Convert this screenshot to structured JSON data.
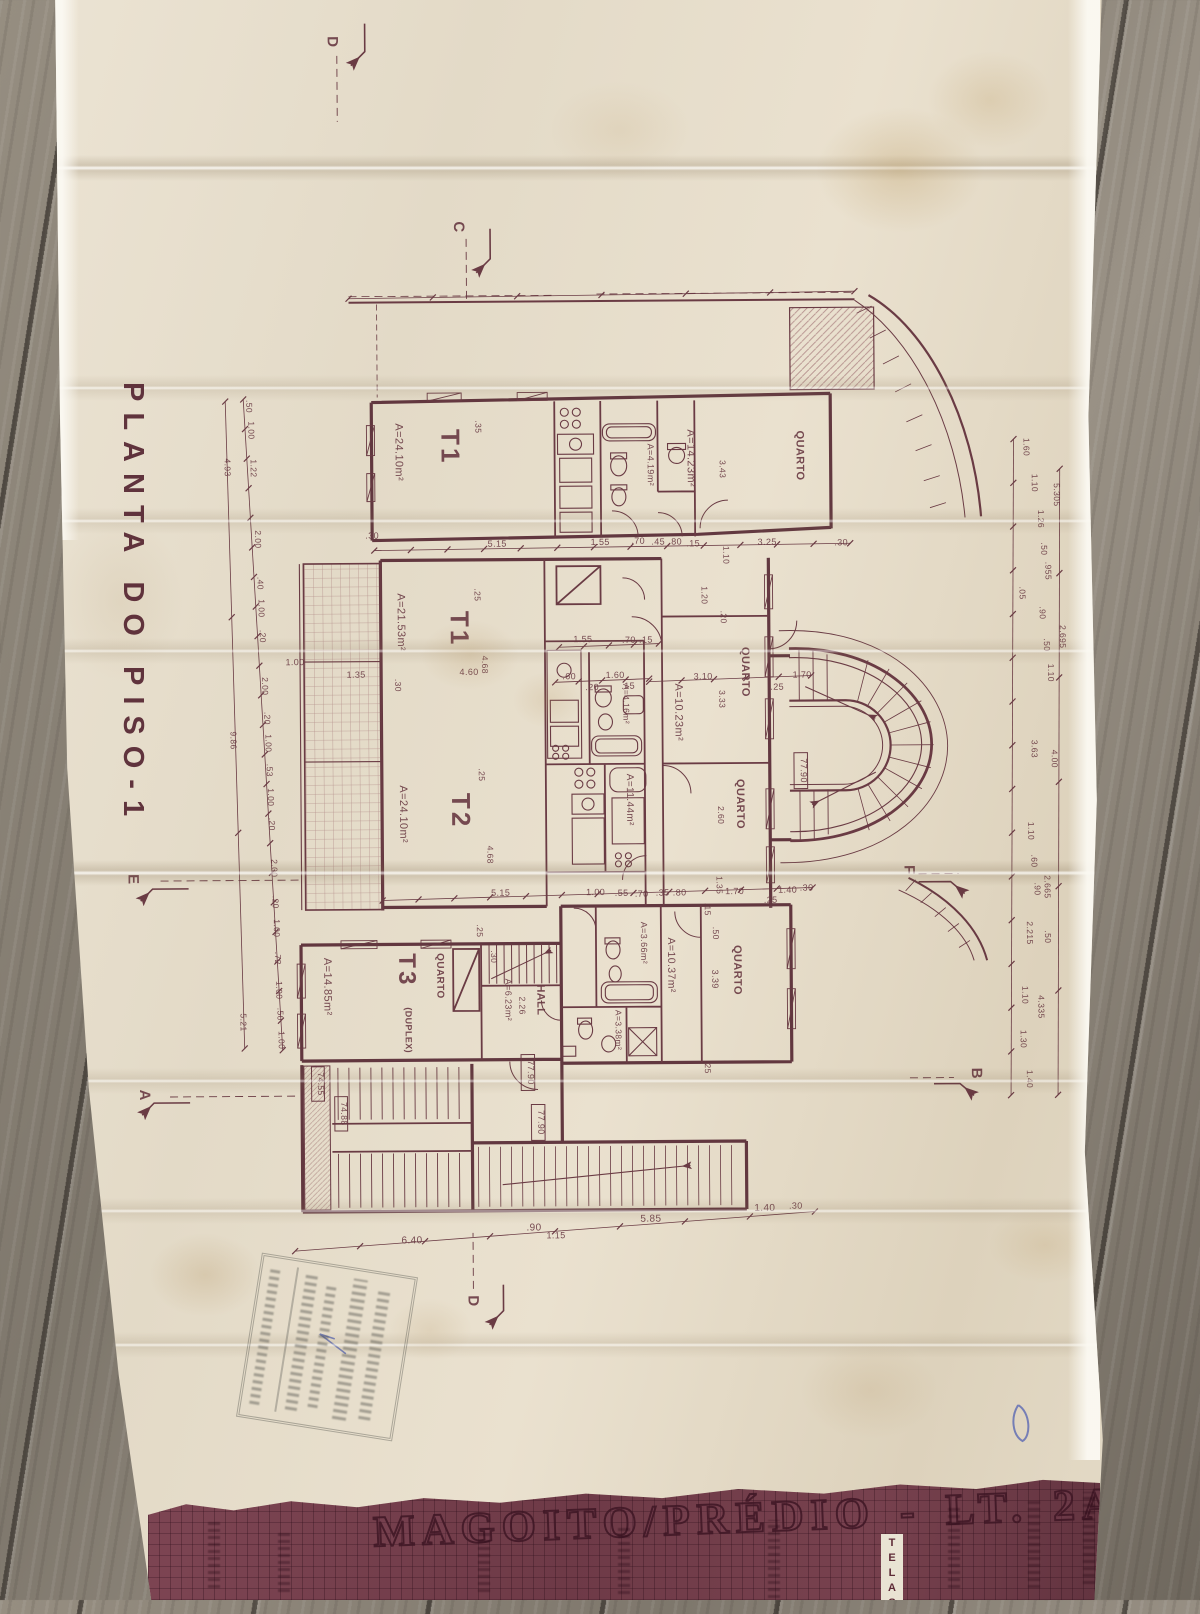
{
  "photo": {
    "plan_title": "PLANTA DO PISO-1",
    "cover_title": "MAGOITO/PRÉDIO - LT. 2A",
    "cover_tag": "TELAS"
  },
  "plan": {
    "labels": {
      "t1a": "T1",
      "t1a_area": "A=24.10m²",
      "q_top": "QUARTO",
      "q_top_area": "A=14.23m²",
      "bath_top_area": "A=4.19m²",
      "t1b": "T1",
      "t1b_area": "A=21.53m²",
      "bath_mid_area": "A=4.16m²",
      "q_m1": "QUARTO",
      "q_m1_area": "A=10.23m²",
      "q_m2": "QUARTO",
      "store_area": "A=11.44m²",
      "t2": "T2",
      "t2_area": "A=24.10m²",
      "t3": "T3",
      "t3_sub": "(DUPLEX)",
      "t3_area": "A=14.85m²",
      "q_t3": "QUARTO",
      "hall": "HALL",
      "hall_area": "A=6.23m²",
      "hall_dim": "2.26",
      "b1_area": "A=3.66m²",
      "b2_area": "A=3.38m²",
      "c_area": "A=10.37m²",
      "q_b": "QUARTO",
      "q_b_dim": "3.39",
      "el1": "77.90",
      "el2": "77.90",
      "el3": "77.90",
      "el4": "74.55",
      "el5": "74.88",
      "sD1": "D",
      "sC": "C",
      "sE": "E",
      "sF": "F",
      "sA": "A",
      "sB": "B",
      "sD2": "D",
      "h1": ".30",
      "h2": "5.15",
      "h3": "1.55",
      "h4": ".70",
      "h5": ".45",
      "h6": ".80",
      "h7": ".15",
      "h8": "3.25",
      "h9": ".30",
      "h10": "1.55",
      "h11": ".70",
      "h12": ".15",
      "h13": ".60",
      "h14": "1.60",
      "h15": ".20",
      "h16": ".15",
      "h17": "3.10",
      "h18": "1.70",
      "h19": ".25",
      "h20": "4.60",
      "h21": "1.35",
      "h22": "1.00",
      "h23": "5.15",
      "h24": "1.00",
      "h25": ".55",
      "h26": ".70",
      "h27": ".35",
      "h28": ".80",
      "h29": "1.70",
      "h30": "1.40",
      "h31": ".30",
      "h32": ".25",
      "h33": "6.40",
      "h34": ".90",
      "h35": "1.15",
      "h36": "5.85",
      "h37": "1.40",
      "h38": ".30",
      "v1": ".35",
      "v2": "3.43",
      "v3": "1.10",
      "v4": ".25",
      "v5": ".30",
      "v6": "4.68",
      "v7": "1.20",
      "v8": "3.33",
      "v9": ".20",
      "v10": "2.60",
      "v11": ".15",
      "v12": ".50",
      "v13": "1.35",
      "v14": ".25",
      "v15": ".30",
      "v16": ".25",
      "v17": "4.68",
      "v18": ".25",
      "L1": ".50",
      "L2": "1.00",
      "L3": "1.22",
      "L4": "2.00",
      "L5": ".40",
      "L6": "1.00",
      "L7": ".20",
      "L8": "2.00",
      "L9": ".20",
      "L10": "1.00",
      "L11": ".53",
      "L12": "1.00",
      "L13": ".20",
      "L14": "2.00",
      "L15": ".20",
      "L16": "1.00",
      "L17": ".72",
      "L18": "1.00",
      "L19": ".50",
      "L20": "1.00",
      "LO1": "4.93",
      "LO2": "9.86",
      "LO3": "5.21",
      "R1": "1.60",
      "R2": "1.10",
      "R3": "1.26",
      "R4": ".50",
      "R5": ".955",
      "R6": ".05",
      "R7": ".90",
      "R8": ".50",
      "R9": "1.10",
      "R10": "3.63",
      "R11": "4.00",
      "R12": "1.10",
      "R13": ".60",
      "R14": ".90",
      "R15": "2.665",
      "R16": "2.215",
      "R17": ".50",
      "R18": "1.10",
      "R19": "4.335",
      "R20": "1.30",
      "R21": "1.40",
      "RO1": "5.305",
      "RO2": "2.695"
    }
  }
}
